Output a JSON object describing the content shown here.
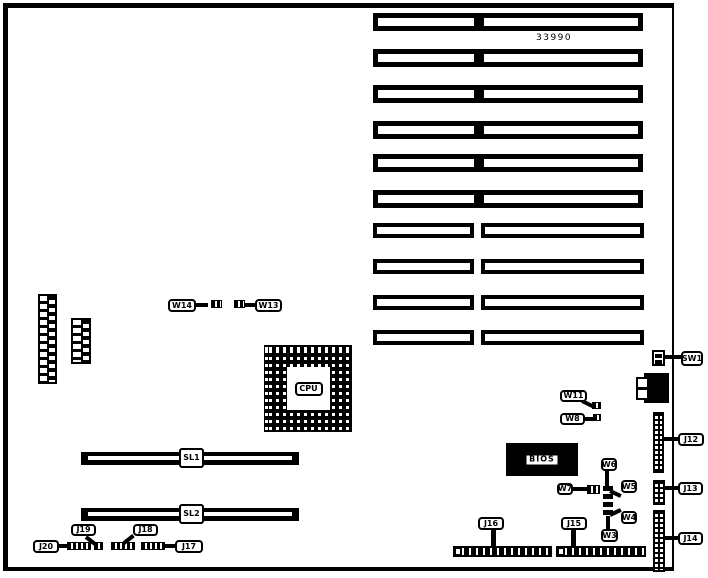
{
  "board": {
    "part_number": "33990",
    "cpu_label": "CPU",
    "bios_label": "BIOS",
    "sl1_label": "SL1",
    "sl2_label": "SL2"
  },
  "callouts": {
    "w3": "W3",
    "w4": "W4",
    "w5": "W5",
    "w6": "W6",
    "w7": "W7",
    "w8": "W8",
    "w11": "W11",
    "w13": "W13",
    "w14": "W14",
    "j12": "J12",
    "j13": "J13",
    "j14": "J14",
    "j15": "J15",
    "j16": "J16",
    "j17": "J17",
    "j18": "J18",
    "j19": "J19",
    "j20": "J20",
    "sw1": "SW1"
  },
  "colors": {
    "ink": "#000000",
    "background": "#ffffff"
  }
}
